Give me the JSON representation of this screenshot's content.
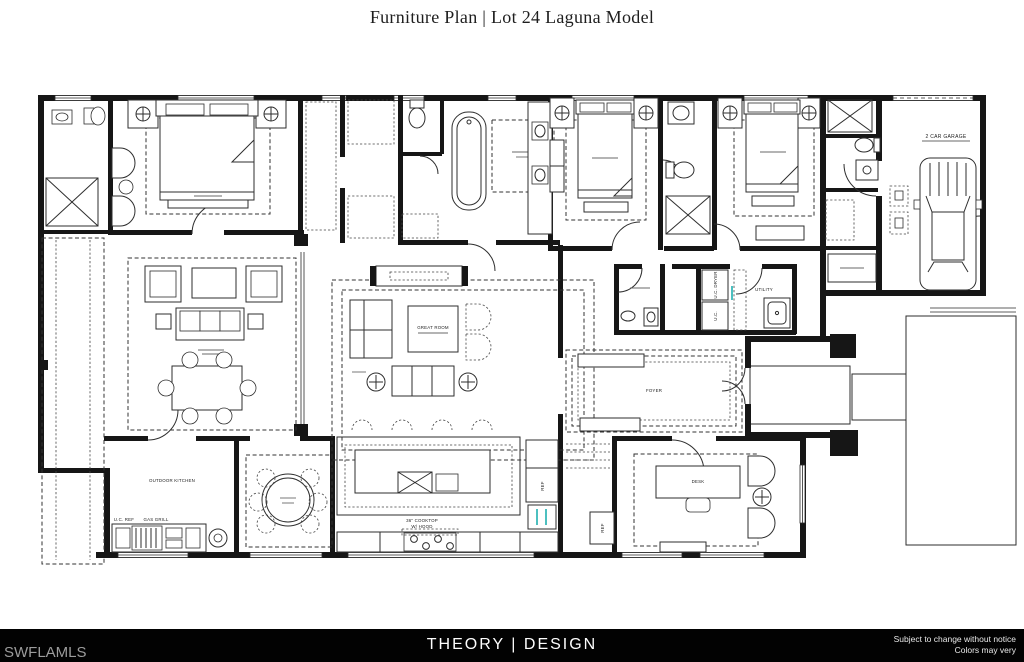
{
  "header": {
    "title": "Furniture Plan | Lot 24 Laguna Model"
  },
  "footer": {
    "brand": "THEORY | DESIGN",
    "watermark": "SWFLAMLS",
    "disclaimer": {
      "line1": "Subject to change without notice",
      "line2": "Colors may very"
    }
  },
  "plan": {
    "labels": {
      "great_room": "GREAT ROOM",
      "cooktop_line1": "36\" COOKTOP",
      "cooktop_line2": "W/ HOOD",
      "outdoor_kitchen": "OUTDOOR KITCHEN",
      "uc_ref": "U.C. REF",
      "gas_grill": "GAS GRILL",
      "garage": "2 CAR GARAGE",
      "utility": "UTILITY",
      "uc_dryer": "U.C. DRYER",
      "uc_washer": "U.C.",
      "ref_1": "REF",
      "ref_2": "REF",
      "foyer": "FOYER",
      "desk": "DESK"
    },
    "colors": {
      "ink": "#1d1d1d",
      "accent_teal": "#00a5a5",
      "footer_bg": "#020202",
      "watermark_gray": "#9c9c9c"
    }
  }
}
